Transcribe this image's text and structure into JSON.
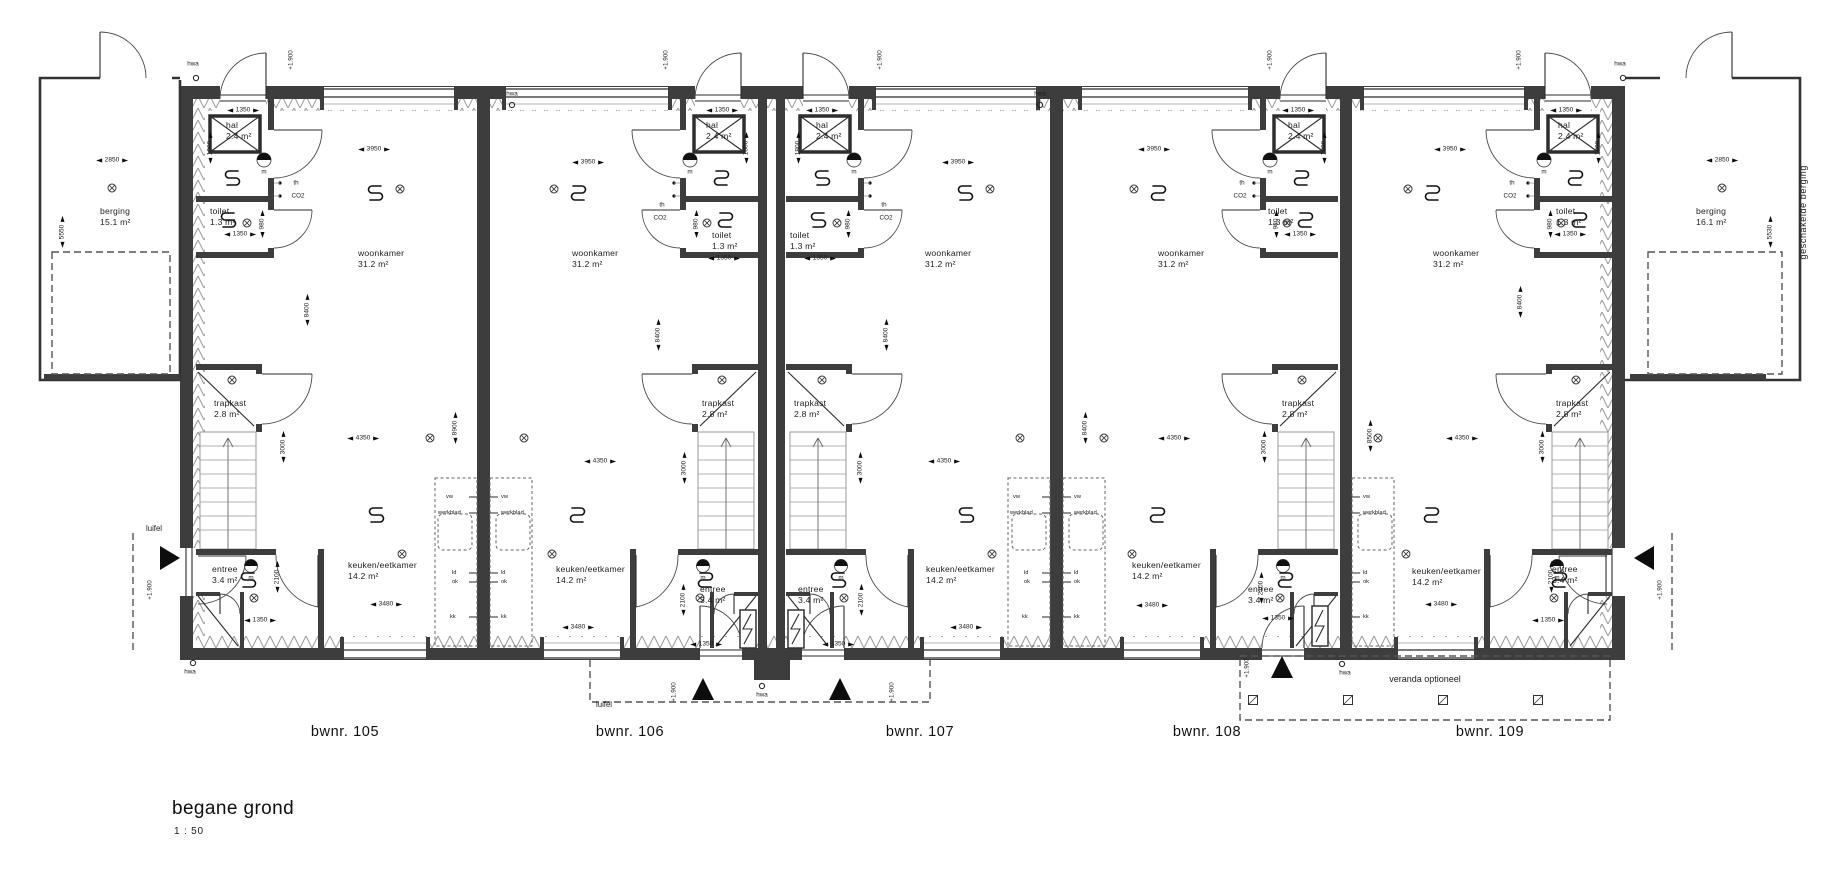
{
  "drawing": {
    "title": "begane grond",
    "scale": "1 : 50"
  },
  "units": {
    "u105": {
      "label": "bwnr. 105"
    },
    "u106": {
      "label": "bwnr. 106"
    },
    "u107": {
      "label": "bwnr. 107"
    },
    "u108": {
      "label": "bwnr. 108"
    },
    "u109": {
      "label": "bwnr. 109"
    }
  },
  "rooms": {
    "woonkamer": {
      "name": "woonkamer",
      "area": "31.2 m²"
    },
    "keuken": {
      "name": "keuken/eetkamer",
      "area": "14.2 m²"
    },
    "trapkast": {
      "name": "trapkast",
      "area": "2.8 m²"
    },
    "entree": {
      "name": "entree",
      "area": "3.4 m²"
    },
    "hal": {
      "name": "hal",
      "area": "2.4 m²"
    },
    "toilet": {
      "name": "toilet",
      "area": "1.3 m²"
    },
    "berging_links": {
      "name": "berging",
      "area": "15.1 m²"
    },
    "berging_rechts": {
      "name": "berging",
      "area": "16.1 m²"
    }
  },
  "dims": {
    "d3950": "3950",
    "d8400": "8400",
    "d8500": "8500",
    "d8900": "8900",
    "d4350": "4350",
    "d3000": "3000",
    "d3480": "3480",
    "d2100": "2100",
    "d1350": "1350",
    "d1800": "1800",
    "d980": "980",
    "d2850": "2850",
    "d5550": "5550",
    "d5530": "5530"
  },
  "ann": {
    "hwa": "hwa",
    "luifel": "luifel",
    "veranda": "veranda optioneel",
    "geschakelde": "geschakelde berging",
    "level": "+1.900",
    "m": "m",
    "th": "th",
    "co2": "CO2",
    "vw": "vw",
    "werkblad": "werkblad",
    "ld": "ld",
    "ok": "ok",
    "kk": "kk"
  }
}
